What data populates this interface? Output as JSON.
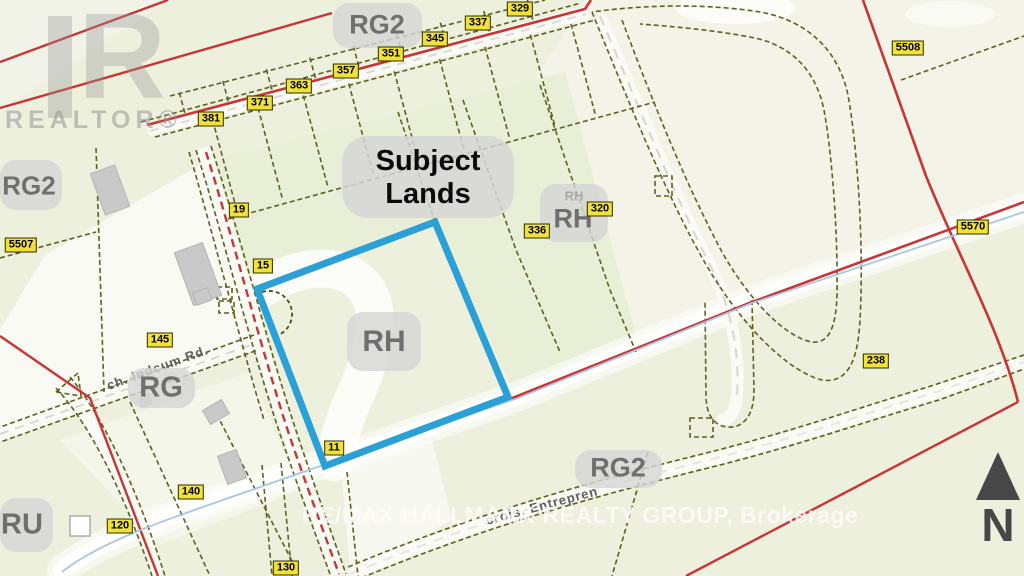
{
  "map": {
    "title_note": "zoning parcel map",
    "markers": [
      {
        "label": "329"
      },
      {
        "label": "337"
      },
      {
        "label": "345"
      },
      {
        "label": "351"
      },
      {
        "label": "357"
      },
      {
        "label": "363"
      },
      {
        "label": "371"
      },
      {
        "label": "381"
      },
      {
        "label": "5508"
      },
      {
        "label": "5507"
      },
      {
        "label": "19"
      },
      {
        "label": "15"
      },
      {
        "label": "336"
      },
      {
        "label": "320"
      },
      {
        "label": "5570"
      },
      {
        "label": "238"
      },
      {
        "label": "145"
      },
      {
        "label": "11"
      },
      {
        "label": "140"
      },
      {
        "label": "120"
      },
      {
        "label": "130"
      }
    ],
    "zones": [
      {
        "label": "RG2"
      },
      {
        "label": "RG2"
      },
      {
        "label": "RH"
      },
      {
        "label": "RH"
      },
      {
        "label": "RH"
      },
      {
        "label": "RG"
      },
      {
        "label": "RU"
      },
      {
        "label": "RG2"
      }
    ],
    "subject": {
      "line1": "Subject",
      "line2": "Lands"
    },
    "roads": [
      {
        "name": "ch. Indcum Rd."
      },
      {
        "name": "crois. Entrepren"
      }
    ],
    "watermarks": {
      "realtor_logo_letter": "R",
      "realtor_text": "REALTOR®",
      "brokerage": "RE/MAX HALLMARK REALTY GROUP, Brokerage"
    },
    "north_label": "N",
    "colors": {
      "background": "#edf0dd",
      "background_cream": "#f3f4e7",
      "parcel_line": "#5f5f20",
      "zoning_red": "#c93434",
      "subject_blue": "#2aa0d6",
      "marker_yellow": "#f0e13c",
      "stream_blue": "#a9c8e0",
      "zone_text_gray": "#6f6f6f"
    }
  }
}
